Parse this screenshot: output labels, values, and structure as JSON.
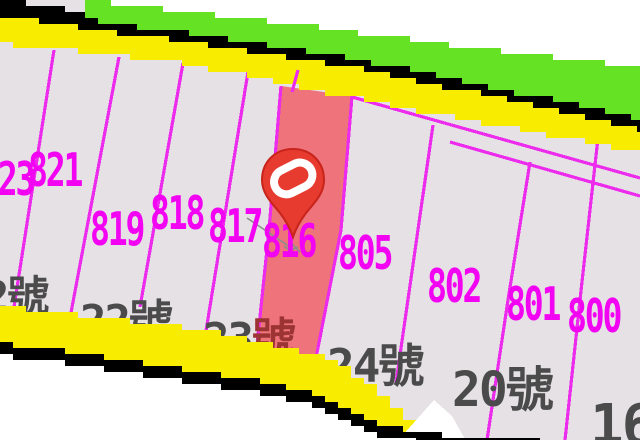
{
  "app": {
    "type": "cadastral-map-viewer"
  },
  "map": {
    "highlighted_parcel": "816",
    "parcels": {
      "p823": "823",
      "p821": "821",
      "p819": "819",
      "p818": "818",
      "p817": "817",
      "p816": "816",
      "p805": "805",
      "p802": "802",
      "p801": "801",
      "p800": "800"
    },
    "house_numbers": {
      "left_partial": "2號",
      "n22": "22號",
      "n23_digits": "23",
      "n23_suffix": "號",
      "n24": "24號",
      "n20": "20號",
      "n16": "16"
    },
    "colors": {
      "background_outside": "#FFFFFF",
      "parcel_fill": "#E5E1E5",
      "parcel_line": "#ED2BED",
      "parcel_label": "#F203F2",
      "house_label": "#4B4B4B",
      "road_fill": "#F8EC00",
      "road_casing": "#000000",
      "vegetation": "#66E225",
      "highlight_fill": "#EE737A",
      "pin_red": "#E73B30"
    }
  }
}
